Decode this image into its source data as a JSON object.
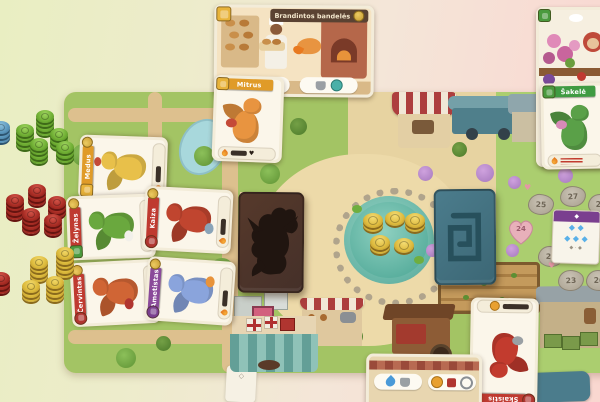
{
  "cards": {
    "top_shop": {
      "title": "Brandintos bandelės"
    },
    "mitrus": {
      "name": "Mitrus"
    },
    "sakele": {
      "name": "Šakelė"
    },
    "hand_left": [
      {
        "name": "Medus"
      },
      {
        "name": "Želynas"
      },
      {
        "name": "Kaiza"
      },
      {
        "name": "Červintas"
      },
      {
        "name": "Ametistas"
      }
    ],
    "bottom_dragon": {
      "name": "Skaistis"
    }
  },
  "board": {
    "score_stones": [
      {
        "value": "25"
      },
      {
        "value": "27"
      },
      {
        "value": "28"
      },
      {
        "value": "24"
      },
      {
        "value": "25"
      },
      {
        "value": "23"
      },
      {
        "value": "26"
      }
    ],
    "reference_card": {
      "row1": "◆ ◆",
      "row2": "◆ ◆ ◆",
      "row3": "◆ · ◆"
    }
  },
  "tokens": {
    "green_stacks": [
      4,
      4,
      3,
      4,
      3
    ],
    "red_stacks": [
      3,
      4,
      3,
      4,
      3
    ],
    "yellow_stacks": [
      4,
      5,
      3,
      4,
      3
    ],
    "blue_stacks": [
      3
    ],
    "red_edge_stacks": [
      3
    ],
    "pond_coin_stacks": [
      2,
      1,
      2,
      2,
      1
    ]
  },
  "colors": {
    "green_token": "#6fae33",
    "red_token": "#a82c24",
    "coin": "#dcb93a",
    "blue_token": "#5a96bc",
    "dragon_deck": "#4a332a",
    "fancy_deck": "#44707e",
    "board_tan": "#e7d3a1",
    "banner_red": "#bf3a30",
    "banner_orange": "#e09b28",
    "banner_green": "#3f9b42",
    "banner_purple": "#8a4a9a"
  }
}
